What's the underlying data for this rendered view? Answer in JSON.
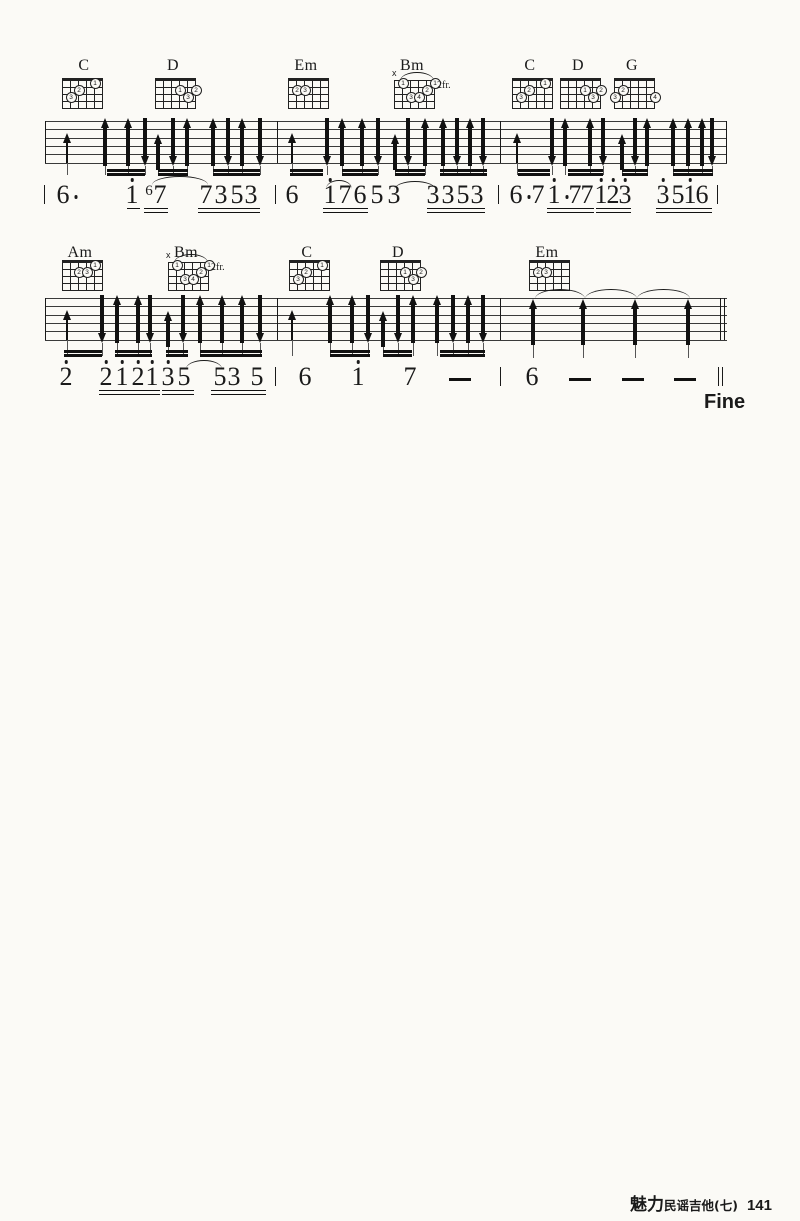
{
  "fine": "Fine",
  "footer": {
    "brand": "魅力",
    "series": "民谣吉他(七)",
    "page_no": "141"
  },
  "notation": {
    "ink": "#1a1a1a",
    "paper": "#fbfaf6",
    "systems": [
      {
        "staff": {
          "x1": 45,
          "x2": 727,
          "top": 121,
          "spacing": 8.3,
          "lines": 6
        },
        "barlines": [
          {
            "x": 45
          },
          {
            "x": 277
          },
          {
            "x": 500
          },
          {
            "x": 726
          }
        ],
        "chord_label_y": 57,
        "grid_top": 80,
        "chords": [
          {
            "name": "C",
            "label_x": 84,
            "grid_x": 62,
            "fingers": [
              [
                1,
                5,
                "1"
              ],
              [
                2,
                3,
                "2"
              ],
              [
                3,
                2,
                "3"
              ]
            ]
          },
          {
            "name": "D",
            "label_x": 173,
            "grid_x": 155,
            "fingers": [
              [
                2,
                4,
                "1"
              ],
              [
                2,
                6,
                "2"
              ],
              [
                3,
                5,
                "3"
              ]
            ]
          },
          {
            "name": "Em",
            "label_x": 306,
            "grid_x": 288,
            "fingers": [
              [
                2,
                2,
                "2"
              ],
              [
                2,
                3,
                "3"
              ]
            ]
          },
          {
            "name": "Bm",
            "label_x": 412,
            "grid_x": 394,
            "x_mark": true,
            "barre": true,
            "fr": "2fr.",
            "fingers": [
              [
                1,
                2,
                "1"
              ],
              [
                1,
                6,
                "1"
              ],
              [
                2,
                5,
                "2"
              ],
              [
                3,
                3,
                "3"
              ],
              [
                3,
                4,
                "4"
              ]
            ]
          },
          {
            "name": "C",
            "label_x": 530,
            "grid_x": 512,
            "fingers": [
              [
                1,
                5,
                "1"
              ],
              [
                2,
                3,
                "2"
              ],
              [
                3,
                2,
                "3"
              ]
            ]
          },
          {
            "name": "D",
            "label_x": 578,
            "grid_x": 560,
            "fingers": [
              [
                2,
                4,
                "1"
              ],
              [
                2,
                6,
                "2"
              ],
              [
                3,
                5,
                "3"
              ]
            ]
          },
          {
            "name": "G",
            "label_x": 632,
            "grid_x": 614,
            "fingers": [
              [
                2,
                2,
                "2"
              ],
              [
                3,
                1,
                "3"
              ],
              [
                3,
                6,
                "4"
              ]
            ]
          }
        ],
        "arrows": [
          [
            67,
            "u",
            "b"
          ],
          [
            105,
            "u",
            "t"
          ],
          [
            128,
            "u",
            "t"
          ],
          [
            145,
            "d",
            "t"
          ],
          [
            158,
            "u",
            "m"
          ],
          [
            173,
            "d",
            "t"
          ],
          [
            187,
            "u",
            "t"
          ],
          [
            213,
            "u",
            "t"
          ],
          [
            228,
            "d",
            "t"
          ],
          [
            242,
            "u",
            "t"
          ],
          [
            260,
            "d",
            "t"
          ],
          [
            292,
            "u",
            "b"
          ],
          [
            327,
            "d",
            "t"
          ],
          [
            342,
            "u",
            "t"
          ],
          [
            362,
            "u",
            "t"
          ],
          [
            378,
            "d",
            "t"
          ],
          [
            395,
            "u",
            "m"
          ],
          [
            408,
            "d",
            "t"
          ],
          [
            425,
            "u",
            "t"
          ],
          [
            443,
            "u",
            "t"
          ],
          [
            457,
            "d",
            "t"
          ],
          [
            470,
            "u",
            "t"
          ],
          [
            483,
            "d",
            "t"
          ],
          [
            517,
            "u",
            "b"
          ],
          [
            552,
            "d",
            "t"
          ],
          [
            565,
            "u",
            "t"
          ],
          [
            590,
            "u",
            "t"
          ],
          [
            603,
            "d",
            "t"
          ],
          [
            622,
            "u",
            "m"
          ],
          [
            635,
            "d",
            "t"
          ],
          [
            647,
            "u",
            "t"
          ],
          [
            673,
            "u",
            "t"
          ],
          [
            688,
            "u",
            "t"
          ],
          [
            702,
            "u",
            "t"
          ],
          [
            712,
            "d",
            "t"
          ]
        ],
        "beam_y": 169,
        "beams": [
          [
            107,
            145
          ],
          [
            158,
            188
          ],
          [
            213,
            260
          ],
          [
            290,
            323
          ],
          [
            342,
            378
          ],
          [
            395,
            425
          ],
          [
            440,
            487
          ],
          [
            518,
            550
          ],
          [
            568,
            603
          ],
          [
            622,
            648
          ],
          [
            673,
            713
          ]
        ],
        "num_top": 182,
        "ul_y": 208,
        "num_bars": [
          {
            "x": 44
          },
          {
            "x": 275
          },
          {
            "x": 498
          },
          {
            "x": 717
          }
        ],
        "notes": [
          {
            "x": 63,
            "t": "6",
            "aft": 1
          },
          {
            "x": 132,
            "t": "1",
            "hi": 1
          },
          {
            "x": 149,
            "t": "6",
            "sm": 1
          },
          {
            "x": 160,
            "t": "7"
          },
          {
            "x": 206,
            "t": "7"
          },
          {
            "x": 221,
            "t": "3"
          },
          {
            "x": 237,
            "t": "5"
          },
          {
            "x": 251,
            "t": "3"
          },
          {
            "x": 292,
            "t": "6"
          },
          {
            "x": 330,
            "t": "1",
            "hi": 1
          },
          {
            "x": 345,
            "t": "7"
          },
          {
            "x": 360,
            "t": "6"
          },
          {
            "x": 377,
            "t": "5"
          },
          {
            "x": 394,
            "t": "3"
          },
          {
            "x": 433,
            "t": "3"
          },
          {
            "x": 448,
            "t": "3"
          },
          {
            "x": 463,
            "t": "5"
          },
          {
            "x": 477,
            "t": "3"
          },
          {
            "x": 516,
            "t": "6",
            "aft": 1
          },
          {
            "x": 538,
            "t": "7"
          },
          {
            "x": 554,
            "t": "1",
            "hi": 1,
            "aft": 1
          },
          {
            "x": 575,
            "t": "7"
          },
          {
            "x": 587,
            "t": "7"
          },
          {
            "x": 601,
            "t": "1",
            "hi": 1
          },
          {
            "x": 613,
            "t": "2",
            "hi": 1
          },
          {
            "x": 625,
            "t": "3",
            "hi": 1
          },
          {
            "x": 663,
            "t": "3",
            "hi": 1
          },
          {
            "x": 678,
            "t": "5"
          },
          {
            "x": 690,
            "t": "1",
            "hi": 1
          },
          {
            "x": 702,
            "t": "6"
          }
        ],
        "uls": [
          [
            127,
            140,
            1
          ],
          [
            144,
            168,
            2
          ],
          [
            198,
            260,
            2
          ],
          [
            323,
            368,
            2
          ],
          [
            427,
            485,
            2
          ],
          [
            547,
            594,
            2
          ],
          [
            596,
            631,
            2
          ],
          [
            656,
            712,
            2
          ]
        ],
        "arcs": [
          [
            152,
            208,
            176
          ],
          [
            326,
            352,
            180
          ],
          [
            394,
            436,
            181
          ]
        ]
      },
      {
        "staff": {
          "x1": 45,
          "x2": 727,
          "top": 298,
          "spacing": 8.3,
          "lines": 6
        },
        "barlines": [
          {
            "x": 45
          },
          {
            "x": 277
          },
          {
            "x": 500
          },
          {
            "x": 720,
            "d": 1
          }
        ],
        "chord_label_y": 244,
        "grid_top": 262,
        "chords": [
          {
            "name": "Am",
            "label_x": 80,
            "grid_x": 62,
            "fingers": [
              [
                1,
                5,
                "1"
              ],
              [
                2,
                3,
                "2"
              ],
              [
                2,
                4,
                "3"
              ]
            ]
          },
          {
            "name": "Bm",
            "label_x": 186,
            "grid_x": 168,
            "x_mark": true,
            "barre": true,
            "fr": "2fr.",
            "fingers": [
              [
                1,
                2,
                "1"
              ],
              [
                1,
                6,
                "1"
              ],
              [
                2,
                5,
                "2"
              ],
              [
                3,
                3,
                "3"
              ],
              [
                3,
                4,
                "4"
              ]
            ]
          },
          {
            "name": "C",
            "label_x": 307,
            "grid_x": 289,
            "fingers": [
              [
                1,
                5,
                "1"
              ],
              [
                2,
                3,
                "2"
              ],
              [
                3,
                2,
                "3"
              ]
            ]
          },
          {
            "name": "D",
            "label_x": 398,
            "grid_x": 380,
            "fingers": [
              [
                2,
                4,
                "1"
              ],
              [
                2,
                6,
                "2"
              ],
              [
                3,
                5,
                "3"
              ]
            ]
          },
          {
            "name": "Em",
            "label_x": 547,
            "grid_x": 529,
            "fingers": [
              [
                2,
                2,
                "2"
              ],
              [
                2,
                3,
                "3"
              ]
            ]
          }
        ],
        "arrows": [
          [
            67,
            "u",
            "b"
          ],
          [
            102,
            "d",
            "t"
          ],
          [
            117,
            "u",
            "t"
          ],
          [
            138,
            "u",
            "t"
          ],
          [
            150,
            "d",
            "t"
          ],
          [
            168,
            "u",
            "m"
          ],
          [
            183,
            "d",
            "t"
          ],
          [
            200,
            "u",
            "t"
          ],
          [
            222,
            "u",
            "t"
          ],
          [
            242,
            "u",
            "t"
          ],
          [
            260,
            "d",
            "t"
          ],
          [
            292,
            "u",
            "b"
          ],
          [
            330,
            "u",
            "t"
          ],
          [
            352,
            "u",
            "t"
          ],
          [
            368,
            "d",
            "t"
          ],
          [
            383,
            "u",
            "m"
          ],
          [
            398,
            "d",
            "t"
          ],
          [
            413,
            "u",
            "t"
          ],
          [
            437,
            "u",
            "t"
          ],
          [
            453,
            "d",
            "t"
          ],
          [
            468,
            "u",
            "t"
          ],
          [
            483,
            "d",
            "t"
          ],
          [
            533,
            "u",
            "w"
          ],
          [
            583,
            "u",
            "w"
          ],
          [
            635,
            "u",
            "w"
          ],
          [
            688,
            "u",
            "w"
          ]
        ],
        "beam_y": 350,
        "beams": [
          [
            64,
            102
          ],
          [
            115,
            152
          ],
          [
            166,
            188
          ],
          [
            200,
            262
          ],
          [
            330,
            370
          ],
          [
            383,
            412
          ],
          [
            440,
            485
          ]
        ],
        "num_top": 364,
        "ul_y": 390,
        "num_bars": [
          {
            "x": 275
          },
          {
            "x": 500
          },
          {
            "x": 718,
            "d": 1
          }
        ],
        "notes": [
          {
            "x": 66,
            "t": "2",
            "hi": 1
          },
          {
            "x": 106,
            "t": "2",
            "hi": 1
          },
          {
            "x": 122,
            "t": "1",
            "hi": 1
          },
          {
            "x": 138,
            "t": "2",
            "hi": 1
          },
          {
            "x": 152,
            "t": "1",
            "hi": 1
          },
          {
            "x": 168,
            "t": "3",
            "hi": 1
          },
          {
            "x": 184,
            "t": "5"
          },
          {
            "x": 220,
            "t": "5"
          },
          {
            "x": 234,
            "t": "3"
          },
          {
            "x": 257,
            "t": "5"
          },
          {
            "x": 305,
            "t": "6"
          },
          {
            "x": 358,
            "t": "1",
            "hi": 1
          },
          {
            "x": 410,
            "t": "7"
          },
          {
            "x": 460,
            "dash": 1
          },
          {
            "x": 532,
            "t": "6"
          },
          {
            "x": 580,
            "dash": 1
          },
          {
            "x": 633,
            "dash": 1
          },
          {
            "x": 685,
            "dash": 1
          }
        ],
        "uls": [
          [
            99,
            160,
            2
          ],
          [
            162,
            194,
            2
          ],
          [
            211,
            266,
            2
          ]
        ],
        "arcs": [
          [
            186,
            222,
            360
          ]
        ],
        "whole_arcs": [
          [
            535,
            585
          ],
          [
            585,
            637
          ],
          [
            637,
            690
          ]
        ],
        "whole_arc_y": 289,
        "whole_stem_bottom": 358
      }
    ]
  }
}
